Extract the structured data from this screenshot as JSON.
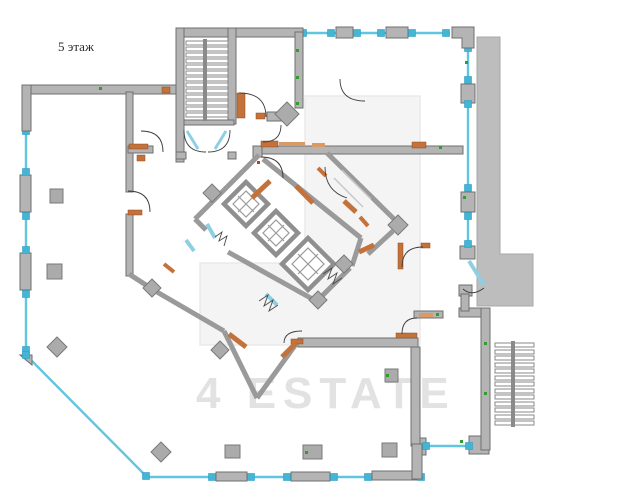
{
  "floor_plan": {
    "floor_label": "5 этаж",
    "watermark_text": "4 ESTATE",
    "features": {
      "elevator_count": 3,
      "staircase_count": 2
    }
  },
  "colors": {
    "wall-fill": "#b4b4b4",
    "wall-edge": "#6f6f6f",
    "wall-line": "#9a9a9a",
    "win": "#62c5e0",
    "win-node": "#45b5d6",
    "door": "#c4713a",
    "door-light": "#d99a66",
    "leaf": "#8ecfe3",
    "stair-stroke": "#8a8a8a",
    "mass": "#bdbdbd",
    "green-mark": "#2f9e2f",
    "watermark": "#e2e2e2",
    "watermark-box": "#f4f4f4",
    "label": "#2b2b2b"
  }
}
